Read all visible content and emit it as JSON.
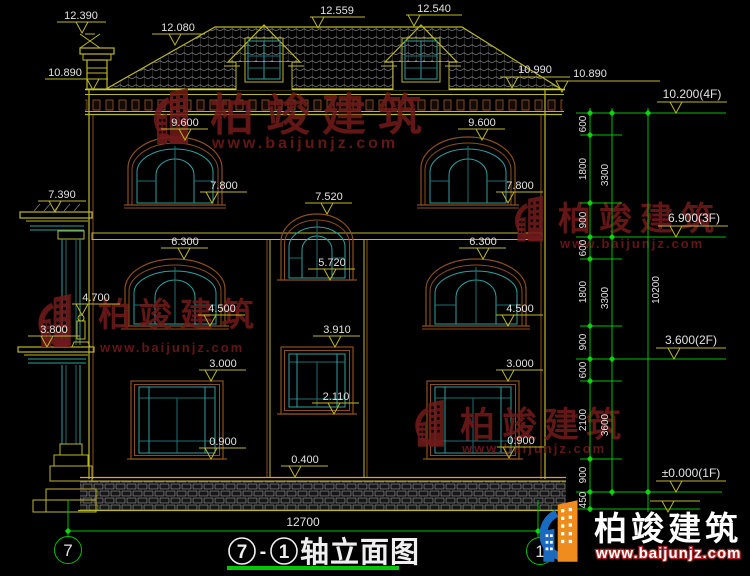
{
  "watermark": {
    "brand": "柏竣建筑",
    "url": "www.baijunjz.com"
  },
  "title": {
    "axis_start": "7",
    "dash": "-",
    "axis_end": "1",
    "name": "轴立面图"
  },
  "axes": {
    "left": "7",
    "right": "1"
  },
  "overall_dim": "12700",
  "dims": {
    "d12390": "12.390",
    "d12080": "12.080",
    "d12559": "12.559",
    "d12540": "12.540",
    "d10890L": "10.890",
    "d10990": "10.990",
    "d10890R": "10.890",
    "lvl4F": "10.200(4F)",
    "lvl3F": "6.900(3F)",
    "lvl2F": "3.600(2F)",
    "lvl1F": "±0.000(1F)",
    "d9600L": "9.600",
    "d9600R": "9.600",
    "d7800L": "7.800",
    "d7800R": "7.800",
    "d7520": "7.520",
    "d7390": "7.390",
    "d6300L": "6.300",
    "d6300R": "6.300",
    "d5720": "5.720",
    "d4700": "4.700",
    "d3800": "3.800",
    "d4500L": "4.500",
    "d4500R": "4.500",
    "d3910": "3.910",
    "d3000L": "3.000",
    "d3000R": "3.000",
    "d2110": "2.110",
    "d0900L": "0.900",
    "d0900R": "0.900",
    "d0400": "0.400"
  },
  "chain": {
    "col1": [
      "600",
      "1800",
      "900",
      "600",
      "1800",
      "900",
      "600",
      "2100",
      "900",
      "450"
    ],
    "col2": [
      "3300",
      "3300",
      "3600"
    ],
    "col3": [
      "10200"
    ]
  }
}
